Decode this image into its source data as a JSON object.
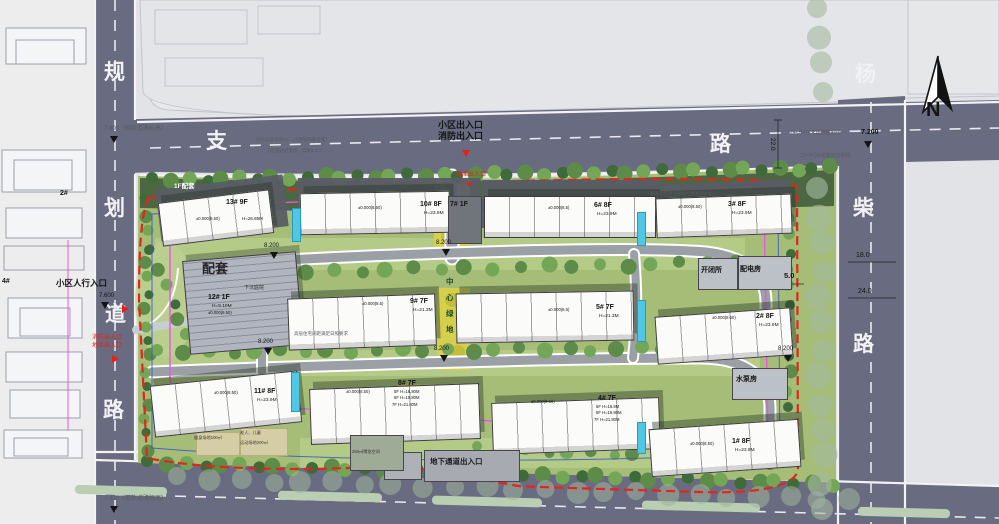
{
  "roads": {
    "left": [
      "规",
      "划",
      "道",
      "路"
    ],
    "top": [
      "支",
      "路"
    ],
    "right": [
      "杨",
      "柴",
      "路"
    ]
  },
  "north": {
    "label": "N"
  },
  "entrances": {
    "top_line1": "小区出入口",
    "top_line2": "消防出入口",
    "top_garage": "地库出入口",
    "left_pedestrian": "小区人行入口",
    "left_fire": "消防出入口",
    "left_garage": "地库出入口",
    "underground": "地下通道出入口"
  },
  "elevations": {
    "road_nw": "7.800（现状道路标高）",
    "road_sw": "7.420（现状道路标高）",
    "road_ne": "7.200",
    "ped_entry": "7.600",
    "site_markers": [
      "8.200",
      "8.200",
      "8.200",
      "8.200",
      "8.200"
    ]
  },
  "dimensions": {
    "top_right": "22.0",
    "right_1": "18.0",
    "right_2": "24.0",
    "setback": "5.0"
  },
  "control_lines": {
    "line1": "24<H<76米建筑控制线",
    "line2": "12<H<24米建筑控制线",
    "note_right": "住宅建筑退让道路红线距离50m",
    "note_top1": "绿化设施带宽2m（含围墙绿篱设置）",
    "note_top2": "小区通透式围墙（高度2.2m）",
    "note_mid": "高层住宅间距满足日照要求"
  },
  "buildings": {
    "b13": {
      "name": "13# 9F",
      "elev": "±0.000(8.50)",
      "height": "H=26.85M"
    },
    "b10": {
      "name": "10# 8F",
      "height": "H=23.9M",
      "elev": "±0.000(8.50)"
    },
    "b7": {
      "name": "7# 1F"
    },
    "b6": {
      "name": "6# 8F",
      "height": "H=23.9M",
      "elev": "±0.000(8.5)"
    },
    "b3": {
      "name": "3# 8F",
      "height": "H=23.9M",
      "elev": "±0.000(8.50)"
    },
    "b12": {
      "tag": "配套",
      "name": "12# 1F",
      "height": "H=5.10M",
      "elev": "±0.000(8.50)"
    },
    "b9": {
      "name": "9# 7F",
      "height": "H=21.3M",
      "elev": "±0.000(8.5)"
    },
    "b5": {
      "name": "5# 7F",
      "height": "H=21.3M",
      "elev": "±0.000(8.5)"
    },
    "b2": {
      "name": "2# 8F",
      "height": "H=23.9M",
      "elev": "±0.000(8.50)"
    },
    "b11": {
      "name": "11# 8F",
      "height": "H=23.9M",
      "elev": "±0.000(8.50)"
    },
    "b8": {
      "name": "8# 7F",
      "l1": "5F H=16.80M",
      "l2": "6F H=19.80M",
      "l3": "7F H=21.80M",
      "elev": "±0.000(8.50)"
    },
    "b4": {
      "name": "4# 7F",
      "l1": "5F H=16.8M",
      "l2": "6F H=19.80M",
      "l3": "7F H=21.80M",
      "elev": "±0.000(8.50)"
    },
    "b1": {
      "name": "1# 8F",
      "height": "H=23.9M",
      "elev": "±0.000(8.50)"
    },
    "podium": "1F配套",
    "sunken": "下沉庭院"
  },
  "facilities": {
    "switch": "开闭所",
    "power": "配电房",
    "pump": "水泵房"
  },
  "green": {
    "central": [
      "中",
      "心",
      "绿",
      "地"
    ]
  },
  "amenities": {
    "fitness": "健身场地100㎡",
    "elderly1": "老人、儿童",
    "elderly2": "运动场地200㎡",
    "expo": "250㎡博览空间"
  },
  "context": {
    "b2": "2#",
    "b4": "4#"
  }
}
